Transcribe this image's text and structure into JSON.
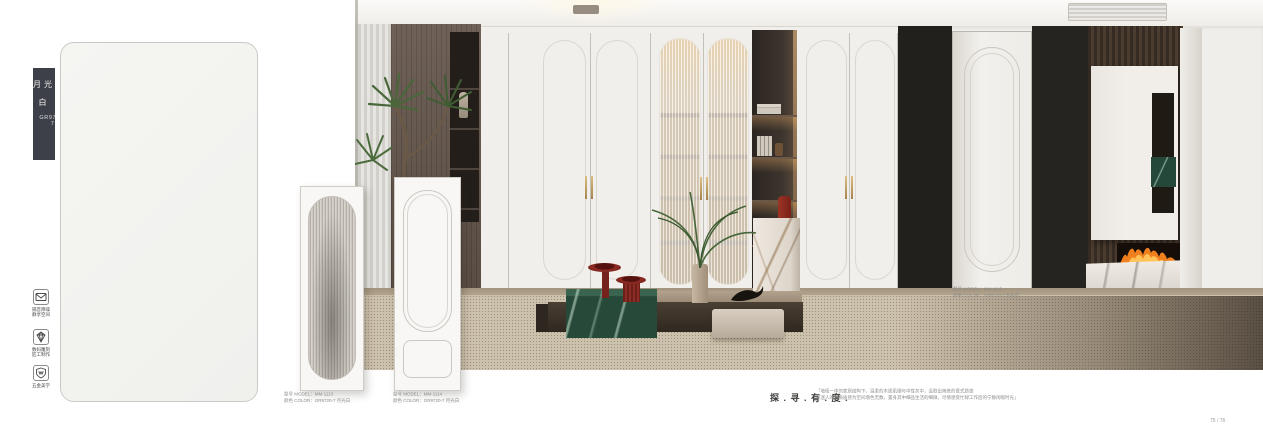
{
  "color_strip": {
    "name": "月光白",
    "code": "GR9720-7"
  },
  "features": [
    {
      "icon": "envelope-icon",
      "line1": "隔音降噪",
      "line2": "静享空间"
    },
    {
      "icon": "diamond-icon",
      "line1": "数码雕刻",
      "line2": "匠工制作"
    },
    {
      "icon": "shield-icon",
      "line1": "五金美学"
    }
  ],
  "products": [
    {
      "model": "型号 MODEL：MM-1113",
      "color": "颜色 COLOR：GR9720-7 月光白"
    },
    {
      "model": "型号 MODEL：MM-1114",
      "color": "颜色 COLOR：GR9720-7 月光白"
    },
    {
      "model": "型号 MODEL：MM-1115",
      "color": "颜色 COLOR：GR9720-7 月光白"
    }
  ],
  "slogan": "探 . 寻 . 有 . 度 .",
  "description": {
    "line1": "「墙柜一体的家居结构下，温柔的木质肌理与中性灰中，汲取出简练的意式质感",
    "line2": "以迷人的材质质感为空间增色无数，置身其中细品生活的细微，尽情感受忙碌工作后的宁静闲暇时光」"
  },
  "page_number": "75 / 76",
  "colors": {
    "accent_gold": "#c3a368",
    "marble_green": "#2b4e3d",
    "wood_brown": "#5d4b3c",
    "table_red": "#7e2523",
    "label_strip": "#3d4049"
  }
}
